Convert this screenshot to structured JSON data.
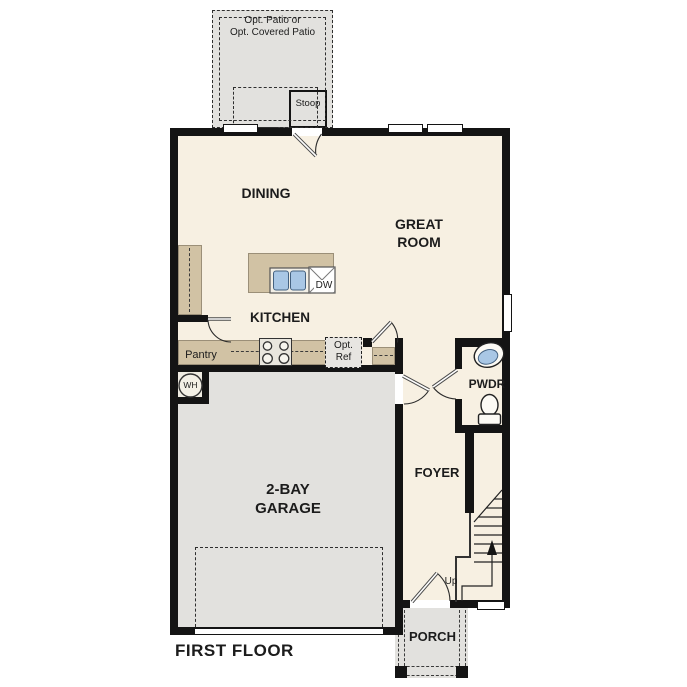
{
  "colors": {
    "wall": "#141414",
    "floor": "#f7f0e2",
    "cabinet": "#d1c2a4",
    "exterior": "#e2e1de",
    "fixture_blue": "#a9c7e5"
  },
  "labels": {
    "patio_line1": "Opt. Patio or",
    "patio_line2": "Opt. Covered Patio",
    "stoop": "Stoop",
    "dining": "DINING",
    "great_room_line1": "GREAT",
    "great_room_line2": "ROOM",
    "kitchen": "KITCHEN",
    "pantry": "Pantry",
    "opt_ref_line1": "Opt.",
    "opt_ref_line2": "Ref",
    "dishwasher": "DW",
    "water_heater": "WH",
    "garage_line1": "2-BAY",
    "garage_line2": "GARAGE",
    "foyer": "FOYER",
    "powder": "PWDR",
    "up": "Up",
    "porch": "PORCH",
    "title": "FIRST FLOOR"
  }
}
